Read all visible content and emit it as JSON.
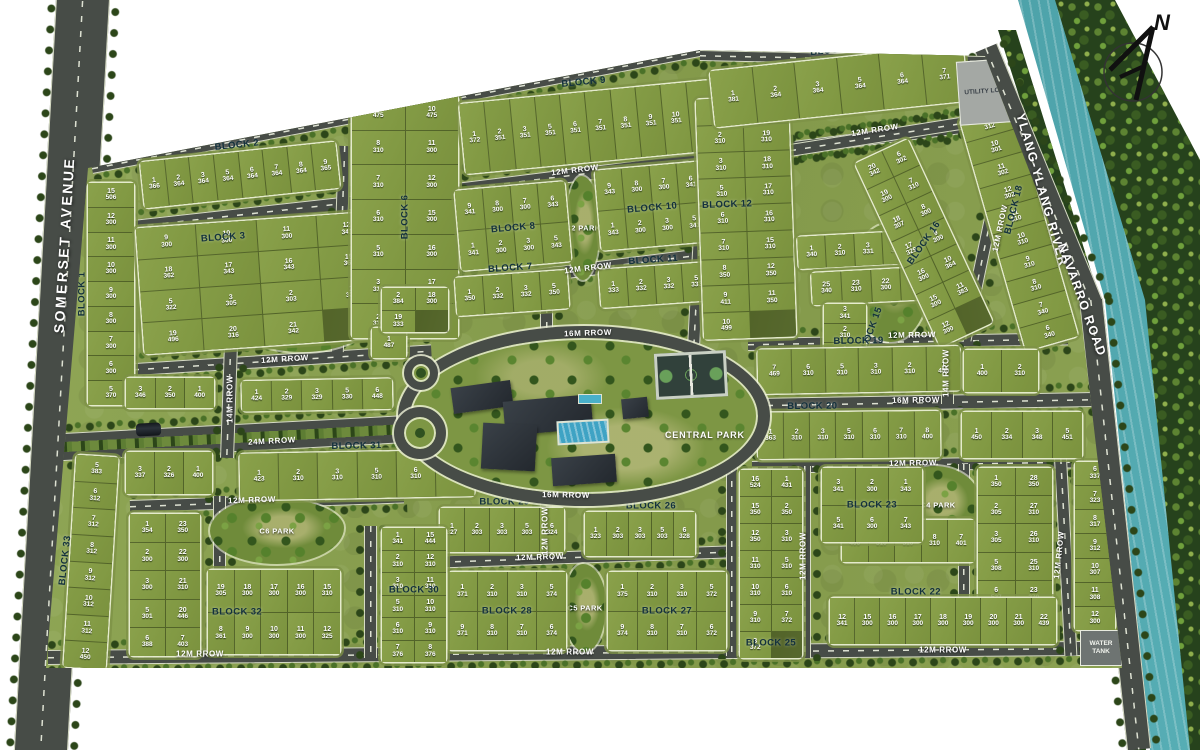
{
  "compass": {
    "label": "N"
  },
  "landmarks": {
    "somerset": "SOMERSET AVENUE",
    "river": "YLANG-YLANG RIVER",
    "navarro": "NAVARRO ROAD",
    "central_park": "CENTRAL PARK",
    "utility_lot": "UTILITY LOT",
    "water_tank": "WATER TANK"
  },
  "colors": {
    "lawn": "#87a04a",
    "road": "#474c47",
    "river": "#3b8b92",
    "forest": "#2b461b",
    "label_dark": "#13313d",
    "lot_text": "#ffffff"
  },
  "road_labels": [
    {
      "t": "12M RROW",
      "x": 575,
      "y": 170,
      "r": -7
    },
    {
      "t": "12M RROW",
      "x": 875,
      "y": 130,
      "r": -9
    },
    {
      "t": "12M RROW",
      "x": 588,
      "y": 268,
      "r": -7
    },
    {
      "t": "12M RROW",
      "x": 285,
      "y": 359,
      "r": -3.5
    },
    {
      "t": "24M RROW",
      "x": 272,
      "y": 441,
      "r": -3
    },
    {
      "t": "12M RROW",
      "x": 252,
      "y": 500,
      "r": -2
    },
    {
      "t": "12M RROW",
      "x": 540,
      "y": 557,
      "r": -2
    },
    {
      "t": "12M RROW",
      "x": 200,
      "y": 654,
      "r": 0
    },
    {
      "t": "12M RROW",
      "x": 570,
      "y": 652,
      "r": 0
    },
    {
      "t": "12M RROW",
      "x": 943,
      "y": 650,
      "r": 0
    },
    {
      "t": "16M RROW",
      "x": 588,
      "y": 333,
      "r": -2
    },
    {
      "t": "16M RROW",
      "x": 566,
      "y": 495,
      "r": 1
    },
    {
      "t": "16M RROW",
      "x": 916,
      "y": 400,
      "r": -1
    },
    {
      "t": "12M RROW",
      "x": 912,
      "y": 335,
      "r": -1
    },
    {
      "t": "12M RROW",
      "x": 913,
      "y": 463,
      "r": -1
    },
    {
      "t": "14M RROW",
      "x": 230,
      "y": 399,
      "r": -90
    },
    {
      "t": "14M RROW",
      "x": 946,
      "y": 373,
      "r": -90
    },
    {
      "t": "12M RROW",
      "x": 803,
      "y": 556,
      "r": -90
    },
    {
      "t": "12M RROW",
      "x": 1059,
      "y": 555,
      "r": -84
    },
    {
      "t": "12M RROW",
      "x": 545,
      "y": 531,
      "r": -90
    },
    {
      "t": "12M RROW",
      "x": 1000,
      "y": 228,
      "r": -78
    }
  ],
  "roads": [
    {
      "x": 92,
      "y": 163,
      "w": 624,
      "h": 9,
      "r": -10.9,
      "o": "0 50%"
    },
    {
      "x": 700,
      "y": 50,
      "w": 288,
      "h": 9,
      "r": 1.2,
      "o": "0 50%"
    },
    {
      "x": 88,
      "y": 225,
      "w": 316,
      "h": 12,
      "r": -6.3,
      "o": "0 50%"
    },
    {
      "x": 400,
      "y": 190,
      "w": 572,
      "h": 12,
      "r": -7.1,
      "o": "0 50%"
    },
    {
      "x": 430,
      "y": 282,
      "w": 364,
      "h": 12,
      "r": -7.1,
      "o": "0 50%"
    },
    {
      "x": 88,
      "y": 366,
      "w": 344,
      "h": 11,
      "r": -3.6,
      "o": "0 50%"
    },
    {
      "x": 45,
      "y": 434,
      "w": 360,
      "h": 26,
      "r": -3,
      "o": "0 50%",
      "k": "r24"
    },
    {
      "x": 130,
      "y": 500,
      "w": 274,
      "h": 11,
      "r": -2,
      "o": "0 50%"
    },
    {
      "x": 425,
      "y": 556,
      "w": 324,
      "h": 11,
      "r": -2,
      "o": "0 50%"
    },
    {
      "x": 48,
      "y": 650,
      "w": 1050,
      "h": 13,
      "r": -0.5,
      "o": "0 50%"
    },
    {
      "x": 752,
      "y": 398,
      "w": 342,
      "h": 13,
      "r": -1,
      "o": "0 50%"
    },
    {
      "x": 752,
      "y": 461,
      "w": 332,
      "h": 11,
      "r": -1,
      "o": "0 50%"
    },
    {
      "x": 748,
      "y": 338,
      "w": 320,
      "h": 11,
      "r": -1,
      "o": "0 50%"
    },
    {
      "x": 790,
      "y": 144,
      "w": 180,
      "h": 11,
      "r": -9,
      "o": "0 50%"
    },
    {
      "x": 1006,
      "y": 113,
      "w": 11,
      "h": 232,
      "r": 11.8,
      "o": "50% 0",
      "v": 1
    },
    {
      "x": 446,
      "y": 164,
      "w": 11,
      "h": 148,
      "r": 2,
      "o": "50% 0",
      "v": 1
    },
    {
      "x": 338,
      "y": 146,
      "w": 11,
      "h": 206,
      "r": 2,
      "o": "50% 0",
      "v": 1
    },
    {
      "x": 700,
      "y": 100,
      "w": 11,
      "h": 244,
      "r": 3,
      "o": "50% 0",
      "v": 1
    },
    {
      "x": 224,
      "y": 344,
      "w": 12,
      "h": 114,
      "r": 2,
      "o": "50% 0",
      "v": 1
    },
    {
      "x": 540,
      "y": 292,
      "w": 11,
      "h": 46,
      "v": 1
    },
    {
      "x": 540,
      "y": 503,
      "w": 11,
      "h": 58,
      "v": 1
    },
    {
      "x": 798,
      "y": 466,
      "w": 11,
      "h": 192,
      "v": 1
    },
    {
      "x": 1054,
      "y": 458,
      "w": 11,
      "h": 198,
      "r": -3,
      "o": "50% 0",
      "v": 1
    },
    {
      "x": 958,
      "y": 464,
      "w": 10,
      "h": 140,
      "v": 1
    },
    {
      "x": 941,
      "y": 344,
      "w": 11,
      "h": 60,
      "v": 1
    },
    {
      "x": 213,
      "y": 496,
      "w": 11,
      "h": 160,
      "v": 1
    },
    {
      "x": 364,
      "y": 526,
      "w": 11,
      "h": 132,
      "v": 1
    },
    {
      "x": 726,
      "y": 466,
      "w": 10,
      "h": 190,
      "v": 1
    }
  ],
  "parks": [
    {
      "label": "C1 PARK",
      "x": 236,
      "y": 294,
      "w": 134,
      "h": 58
    },
    {
      "label": "C2 PARK",
      "x": 566,
      "y": 176,
      "w": 34,
      "h": 104
    },
    {
      "label": "C3 PARK",
      "x": 852,
      "y": 224,
      "w": 78,
      "h": 118
    },
    {
      "label": "C4 PARK",
      "x": 896,
      "y": 466,
      "w": 84,
      "h": 78
    },
    {
      "label": "C5 PARK",
      "x": 564,
      "y": 564,
      "w": 42,
      "h": 88
    },
    {
      "label": "C6 PARK",
      "x": 210,
      "y": 498,
      "w": 134,
      "h": 66
    }
  ],
  "blocks": [
    {
      "label": "BLOCK 1",
      "x": 88,
      "y": 183,
      "w": 46,
      "h": 222,
      "c": 1,
      "lr": -90,
      "lx": -12,
      "ly": 50,
      "lots": [
        "15/506",
        "12/300",
        "11/300",
        "10/300",
        "9/300",
        "8/300",
        "7/300",
        "6/300",
        "5/370"
      ]
    },
    {
      "label": "BLOCK 2",
      "x": 142,
      "y": 152,
      "w": 196,
      "h": 46,
      "r": -6,
      "c": 8,
      "ly": -16,
      "lots": [
        "1/366",
        "2/364",
        "3/364",
        "5/364",
        "6/364",
        "7/364",
        "8/364",
        "9/365"
      ]
    },
    {
      "label": "BLOCK 3",
      "x": 140,
      "y": 220,
      "w": 240,
      "h": 126,
      "r": -4,
      "c": 4,
      "lx": 36,
      "ly": 12,
      "lots": [
        "9/300",
        "10/300",
        "11/300",
        "12/341",
        "18/362",
        "17/343",
        "16/343",
        "15/361",
        "5/322",
        "3/305",
        "2/303",
        "1/338",
        "19/496",
        "20/316",
        "21/342"
      ]
    },
    {
      "label": "BLOCK 6",
      "x": 352,
      "y": 96,
      "w": 106,
      "h": 242,
      "c": 2,
      "lr": -90,
      "lots": [
        "9/475",
        "10/475",
        "8/310",
        "11/300",
        "7/310",
        "12/300",
        "6/310",
        "15/300",
        "5/310",
        "16/300",
        "3/310",
        "17/300",
        "2/310",
        "18/300"
      ]
    },
    {
      "label": "BLOCK 9",
      "x": 462,
      "y": 92,
      "w": 252,
      "h": 70,
      "r": -5.5,
      "c": 10,
      "ly": -14,
      "lots": [
        "1/372",
        "2/351",
        "3/351",
        "5/351",
        "6/351",
        "7/351",
        "8/351",
        "9/351",
        "10/351",
        "11/372"
      ]
    },
    {
      "label": "BLOCK 8",
      "x": 458,
      "y": 186,
      "w": 110,
      "h": 80,
      "r": -5,
      "c": 4,
      "ly": 52,
      "lots": [
        "9/341",
        "8/300",
        "7/300",
        "6/343",
        "1/341",
        "2/300",
        "3/300",
        "5/343"
      ]
    },
    {
      "label": "BLOCK 10",
      "x": 598,
      "y": 166,
      "w": 108,
      "h": 80,
      "r": -5,
      "c": 4,
      "ly": 52,
      "lots": [
        "9/343",
        "8/300",
        "7/300",
        "6/341",
        "1/343",
        "2/300",
        "3/300",
        "5/341"
      ]
    },
    {
      "label": "BLOCK 7",
      "x": 456,
      "y": 274,
      "w": 112,
      "h": 38,
      "r": -4,
      "c": 4,
      "ly": -16,
      "lots": [
        "1/350",
        "2/332",
        "3/332",
        "5/350"
      ]
    },
    {
      "label": "BLOCK 11",
      "x": 600,
      "y": 266,
      "w": 110,
      "h": 38,
      "r": -4,
      "c": 4,
      "ly": -16,
      "lots": [
        "1/333",
        "2/332",
        "3/332",
        "5/333"
      ]
    },
    {
      "label": "BLOCK 12",
      "x": 700,
      "y": 98,
      "w": 92,
      "h": 240,
      "r": -2,
      "c": 2,
      "lx": 30,
      "ly": 44,
      "lots": [
        "1/475",
        "20/490",
        "2/310",
        "19/310",
        "3/310",
        "18/310",
        "5/310",
        "17/310",
        "6/310",
        "16/310",
        "7/310",
        "15/310",
        "8/350",
        "12/350",
        "9/411",
        "11/350",
        "10/499"
      ]
    },
    {
      "label": "BLOCK 17",
      "x": 712,
      "y": 58,
      "w": 254,
      "h": 56,
      "r": -6,
      "c": 6,
      "ly": -14,
      "lots": [
        "1/381",
        "2/364",
        "3/364",
        "5/364",
        "6/364",
        "7/371"
      ]
    },
    {
      "label": "",
      "x": 798,
      "y": 234,
      "w": 112,
      "h": 32,
      "r": -3,
      "c": 4,
      "lots": [
        "1/340",
        "2/310",
        "3/331",
        "5/398"
      ]
    },
    {
      "label": "",
      "x": 812,
      "y": 270,
      "w": 118,
      "h": 32,
      "r": -3,
      "c": 4,
      "lots": [
        "25/340",
        "23/310",
        "22/300",
        "21/346"
      ]
    },
    {
      "label": "BLOCK 15",
      "x": 824,
      "y": 304,
      "w": 42,
      "h": 58,
      "c": 1,
      "lr": -70,
      "lx": 112,
      "ly": 46,
      "lots": [
        "3/341",
        "2/310",
        "1/356"
      ]
    },
    {
      "label": "BLOCK 16",
      "x": 895,
      "y": 142,
      "w": 58,
      "h": 202,
      "r": -25,
      "c": 2,
      "lr": -30,
      "lots": [
        "20/342",
        "6/302",
        "19/300",
        "7/310",
        "18/307",
        "8/300",
        "17/329",
        "9/300",
        "16/300",
        "10/364",
        "15/300",
        "11/383",
        "12/300"
      ]
    },
    {
      "label": "BLOCK 18",
      "x": 992,
      "y": 108,
      "w": 54,
      "h": 240,
      "r": -16,
      "c": 1,
      "lr": -60,
      "lx": 50,
      "ly": 42,
      "lots": [
        "9/312",
        "10/301",
        "11/302",
        "12/302",
        "11/310",
        "10/310",
        "9/310",
        "8/310",
        "7/340",
        "6/340"
      ]
    },
    {
      "label": "BLOCK 19",
      "x": 758,
      "y": 348,
      "w": 202,
      "h": 44,
      "r": -1,
      "c": 6,
      "ly": -15,
      "lots": [
        "7/469",
        "6/310",
        "5/310",
        "3/310",
        "2/310",
        "1/450"
      ]
    },
    {
      "label": "",
      "x": 964,
      "y": 350,
      "w": 74,
      "h": 42,
      "c": 2,
      "lots": [
        "1/400",
        "2/310"
      ]
    },
    {
      "label": "BLOCK 20",
      "x": 758,
      "y": 412,
      "w": 182,
      "h": 46,
      "r": -0.5,
      "c": 7,
      "lx": 30,
      "ly": -14,
      "lots": [
        "1/363",
        "2/310",
        "3/310",
        "5/310",
        "6/310",
        "7/310",
        "8/400"
      ]
    },
    {
      "label": "",
      "x": 962,
      "y": 412,
      "w": 120,
      "h": 46,
      "c": 4,
      "lots": [
        "1/450",
        "2/334",
        "3/348",
        "5/451"
      ]
    },
    {
      "label": "",
      "x": 842,
      "y": 520,
      "w": 132,
      "h": 42,
      "c": 5,
      "lots": [
        "11/400",
        "10/310",
        "9/310",
        "8/310",
        "7/401"
      ]
    },
    {
      "label": "",
      "x": 978,
      "y": 468,
      "w": 74,
      "h": 140,
      "c": 2,
      "lots": [
        "1/350",
        "28/350",
        "2/305",
        "27/310",
        "3/305",
        "26/310",
        "5/308",
        "25/310",
        "6/527",
        "23/370"
      ]
    },
    {
      "label": "BLOCK 22",
      "x": 830,
      "y": 598,
      "w": 226,
      "h": 46,
      "c": 9,
      "lx": 38,
      "ly": -14,
      "lots": [
        "12/341",
        "15/300",
        "16/300",
        "17/300",
        "18/300",
        "19/300",
        "20/300",
        "21/300",
        "22/439"
      ]
    },
    {
      "label": "BLOCK 21",
      "x": 1075,
      "y": 462,
      "w": 40,
      "h": 168,
      "c": 1,
      "lr": -80,
      "lx": 118,
      "ly": 45,
      "lots": [
        "6/337",
        "7/323",
        "8/317",
        "9/312",
        "10/307",
        "11/308",
        "12/300"
      ]
    },
    {
      "label": "BLOCK 23",
      "x": 822,
      "y": 468,
      "w": 100,
      "h": 74,
      "c": 3,
      "ly": 50,
      "lots": [
        "3/341",
        "2/300",
        "1/343",
        "5/341",
        "6/300",
        "7/343"
      ]
    },
    {
      "label": "BLOCK 25",
      "x": 740,
      "y": 470,
      "w": 62,
      "h": 188,
      "c": 2,
      "ly": 92,
      "lots": [
        "16/524",
        "1/431",
        "15/350",
        "2/350",
        "12/350",
        "3/310",
        "11/310",
        "5/310",
        "10/310",
        "6/310",
        "9/310",
        "7/372",
        "8/372"
      ]
    },
    {
      "label": "BLOCK 26",
      "x": 585,
      "y": 512,
      "w": 110,
      "h": 44,
      "c": 5,
      "lx": 60,
      "ly": -14,
      "lots": [
        "1/323",
        "2/303",
        "3/303",
        "5/303",
        "6/328"
      ]
    },
    {
      "label": "BLOCK 29",
      "x": 440,
      "y": 508,
      "w": 124,
      "h": 44,
      "c": 5,
      "lx": 52,
      "ly": -14,
      "lots": [
        "1/327",
        "2/303",
        "3/303",
        "5/303",
        "6/324"
      ]
    },
    {
      "label": "BLOCK 28",
      "x": 448,
      "y": 572,
      "w": 118,
      "h": 78,
      "c": 4,
      "ly": 50,
      "lots": [
        "1/371",
        "2/310",
        "3/310",
        "5/374",
        "9/371",
        "8/310",
        "7/310",
        "6/374"
      ]
    },
    {
      "label": "BLOCK 27",
      "x": 608,
      "y": 572,
      "w": 118,
      "h": 78,
      "c": 4,
      "ly": 50,
      "lots": [
        "1/375",
        "2/310",
        "3/310",
        "5/372",
        "9/374",
        "8/310",
        "7/310",
        "6/372"
      ]
    },
    {
      "label": "BLOCK 30",
      "x": 382,
      "y": 528,
      "w": 64,
      "h": 134,
      "c": 2,
      "ly": 46,
      "lots": [
        "1/341",
        "15/444",
        "2/310",
        "12/310",
        "3/310",
        "11/310",
        "5/310",
        "10/310",
        "6/310",
        "9/310",
        "7/376",
        "8/376"
      ]
    },
    {
      "label": "BLOCK 31",
      "x": 240,
      "y": 452,
      "w": 234,
      "h": 46,
      "r": -1,
      "c": 6,
      "ly": -14,
      "lots": [
        "1/423",
        "2/310",
        "3/310",
        "5/310",
        "6/310",
        "7/366"
      ]
    },
    {
      "label": "",
      "x": 126,
      "y": 452,
      "w": 86,
      "h": 42,
      "c": 3,
      "lots": [
        "3/337",
        "2/326",
        "1/400"
      ]
    },
    {
      "label": "",
      "x": 130,
      "y": 514,
      "w": 70,
      "h": 142,
      "c": 2,
      "lots": [
        "1/354",
        "23/350",
        "2/300",
        "22/300",
        "3/300",
        "21/310",
        "5/301",
        "20/446",
        "6/388",
        "7/403"
      ]
    },
    {
      "label": "BLOCK 32",
      "x": 208,
      "y": 570,
      "w": 132,
      "h": 84,
      "c": 5,
      "lx": 22,
      "ly": 50,
      "lots": [
        "19/305",
        "18/300",
        "17/300",
        "16/300",
        "15/310",
        "8/361",
        "9/300",
        "10/300",
        "11/300",
        "12/325"
      ]
    },
    {
      "label": "BLOCK 33",
      "x": 70,
      "y": 456,
      "w": 42,
      "h": 212,
      "r": 3.5,
      "c": 1,
      "lr": -87,
      "lx": -12,
      "ly": 50,
      "lots": [
        "5/383",
        "6/312",
        "7/312",
        "8/312",
        "9/312",
        "10/312",
        "11/312",
        "12/450"
      ]
    },
    {
      "label": "",
      "x": 126,
      "y": 378,
      "w": 88,
      "h": 30,
      "c": 3,
      "lots": [
        "3/346",
        "2/350",
        "1/400"
      ]
    },
    {
      "label": "",
      "x": 242,
      "y": 380,
      "w": 150,
      "h": 30,
      "r": -1,
      "c": 5,
      "lots": [
        "1/424",
        "2/329",
        "3/329",
        "5/330",
        "6/448"
      ]
    },
    {
      "label": "",
      "x": 372,
      "y": 328,
      "w": 34,
      "h": 30,
      "c": 1,
      "lots": [
        "1/487"
      ]
    },
    {
      "label": "",
      "x": 382,
      "y": 288,
      "w": 66,
      "h": 44,
      "c": 2,
      "lots": [
        "2/384",
        "18/300",
        "19/333"
      ]
    }
  ]
}
